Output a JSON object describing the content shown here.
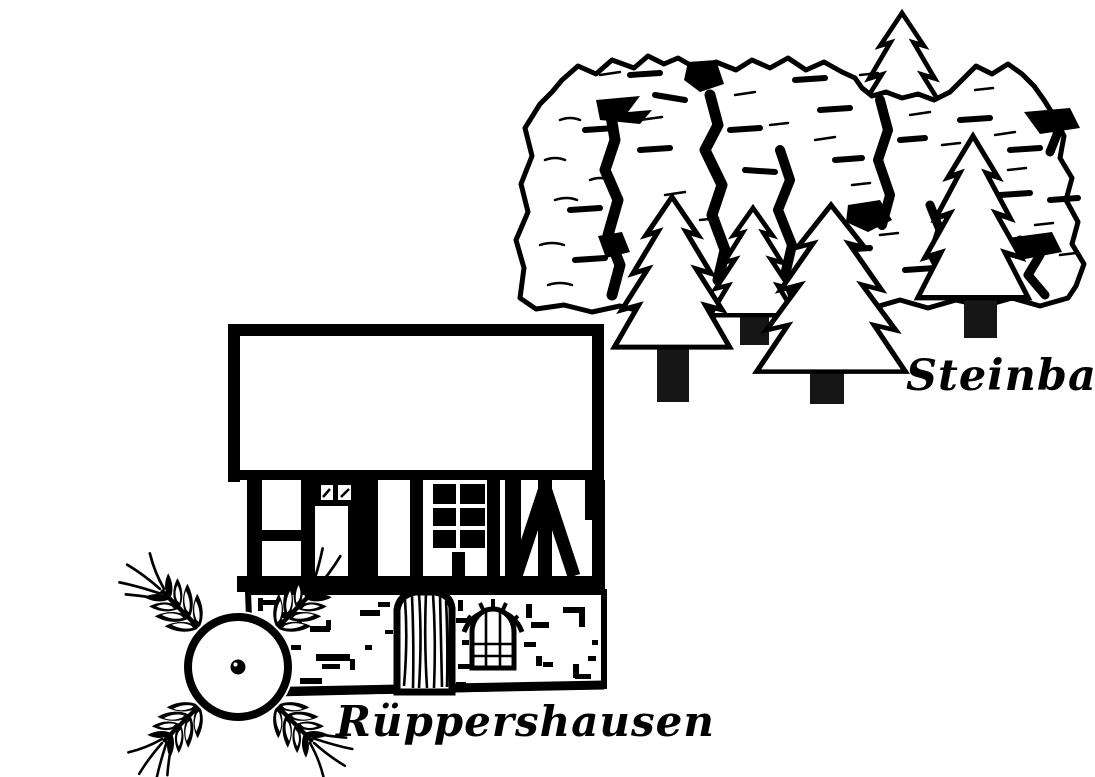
{
  "scene": {
    "paper_color": "#ffffff",
    "ink_color": "#000000",
    "labels": {
      "steinbach": "Steinbach",
      "rueppershausen": "Rüppershausen"
    },
    "icons": {
      "rock_cliff": "rock-cliff-illustration",
      "fir_tree": "fir-tree-icon",
      "fir_tree_count": 5,
      "house": "half-timbered-house-illustration",
      "wheel": "mill-wheel-icon",
      "wheat_ear": "wheat-ear-icon"
    }
  }
}
